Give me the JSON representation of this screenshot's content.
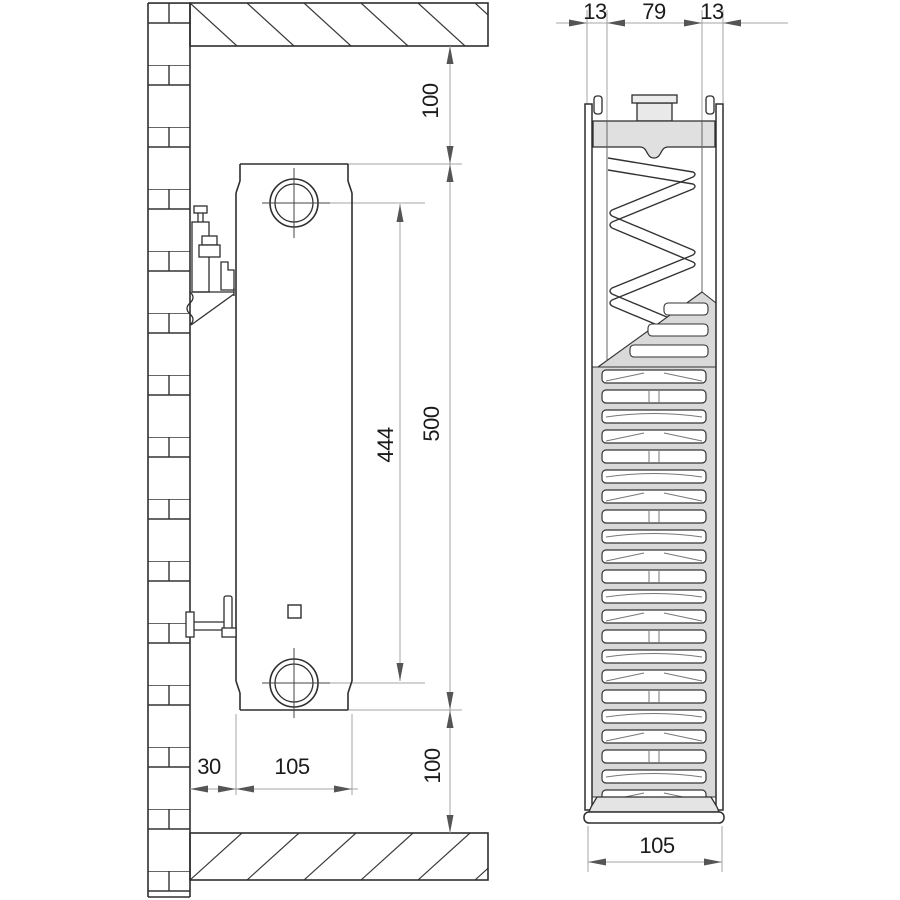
{
  "drawing": {
    "description": "panel radiator wall-mounting drawing, side view and cross-section",
    "colors": {
      "line": "#2e2e2e",
      "dim_line": "#a6a6a6",
      "arrow": "#555555",
      "fill_header": "#e0e0e0",
      "fill_plug": "#e9e9e9",
      "fill_grille": "#d9d9d9",
      "background": "#ffffff"
    },
    "dimensions": {
      "side": {
        "ceiling_clearance": "100",
        "radiator_height": "500",
        "connection_spacing": "444",
        "floor_clearance": "100",
        "wall_distance": "30",
        "radiator_depth": "105"
      },
      "section": {
        "front_panel": "13",
        "core_width": "79",
        "rear_panel": "13",
        "total_depth": "105"
      }
    }
  }
}
